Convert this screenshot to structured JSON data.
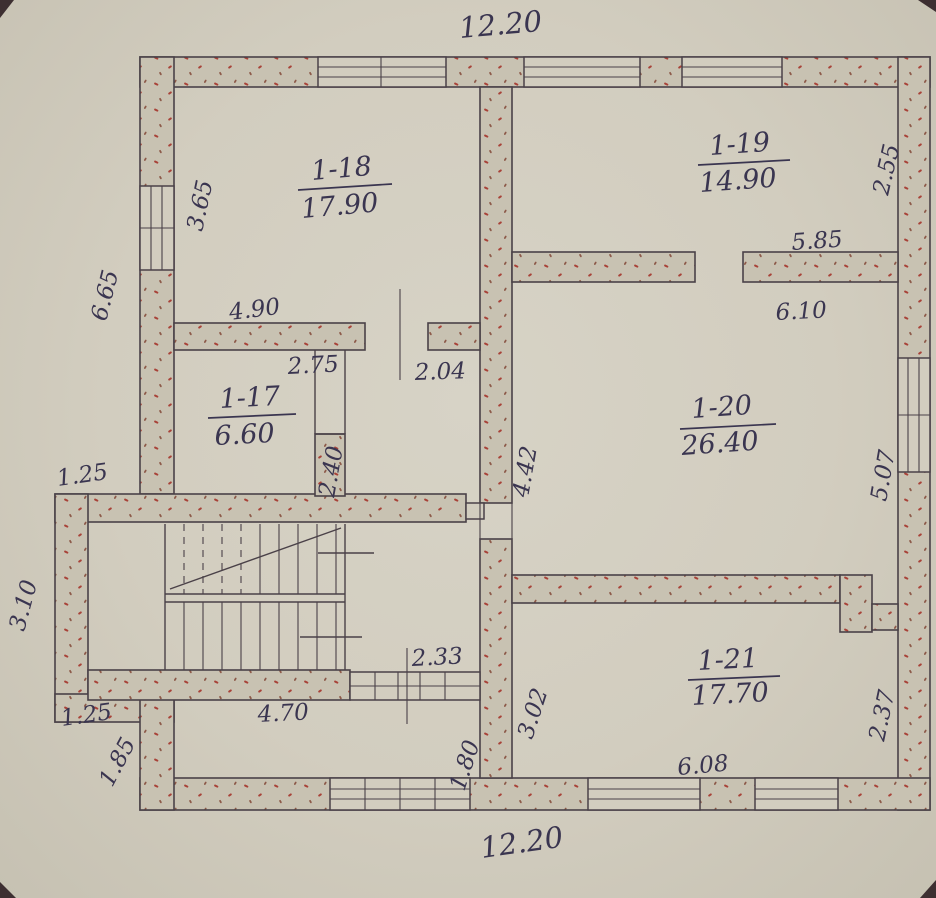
{
  "plan": {
    "title": "hand-drawn floor plan (scanned)",
    "rooms": [
      {
        "number": "1-17",
        "area": "6.60"
      },
      {
        "number": "1-18",
        "area": "17.90"
      },
      {
        "number": "1-19",
        "area": "14.90"
      },
      {
        "number": "1-20",
        "area": "26.40"
      },
      {
        "number": "1-21",
        "area": "17.70"
      }
    ],
    "dimensions": {
      "top_overall": "12.20",
      "bottom_overall": "12.20",
      "left_window": "3.65",
      "left_outer": "6.65",
      "room17_top": "4.90",
      "room17_wall": "2.75",
      "door_18": "2.04",
      "right_upper": "2.55",
      "wall_19_top": "5.85",
      "wall_19_bottom": "6.10",
      "right_middle": "5.07",
      "room20_left": "4.42",
      "room17_right": "2.40",
      "left_step_top": "1.25",
      "left_side_lower": "3.10",
      "left_step_bottom": "1.25",
      "left_bottom_wall": "1.85",
      "stair_bottom": "4.70",
      "porch_wall": "2.33",
      "porch_left": "1.80",
      "room21_left": "3.02",
      "room21_bottom": "6.08",
      "right_lower": "2.37"
    }
  },
  "colors": {
    "paper": "#d2cdbf",
    "wall_fill": "#c8c2b2",
    "ink_line": "#4a4148",
    "ink_text": "#3a3550",
    "stipple": "#a84238",
    "stipple_alt": "#8d5a49",
    "scan_corner": "#2e1f22"
  }
}
